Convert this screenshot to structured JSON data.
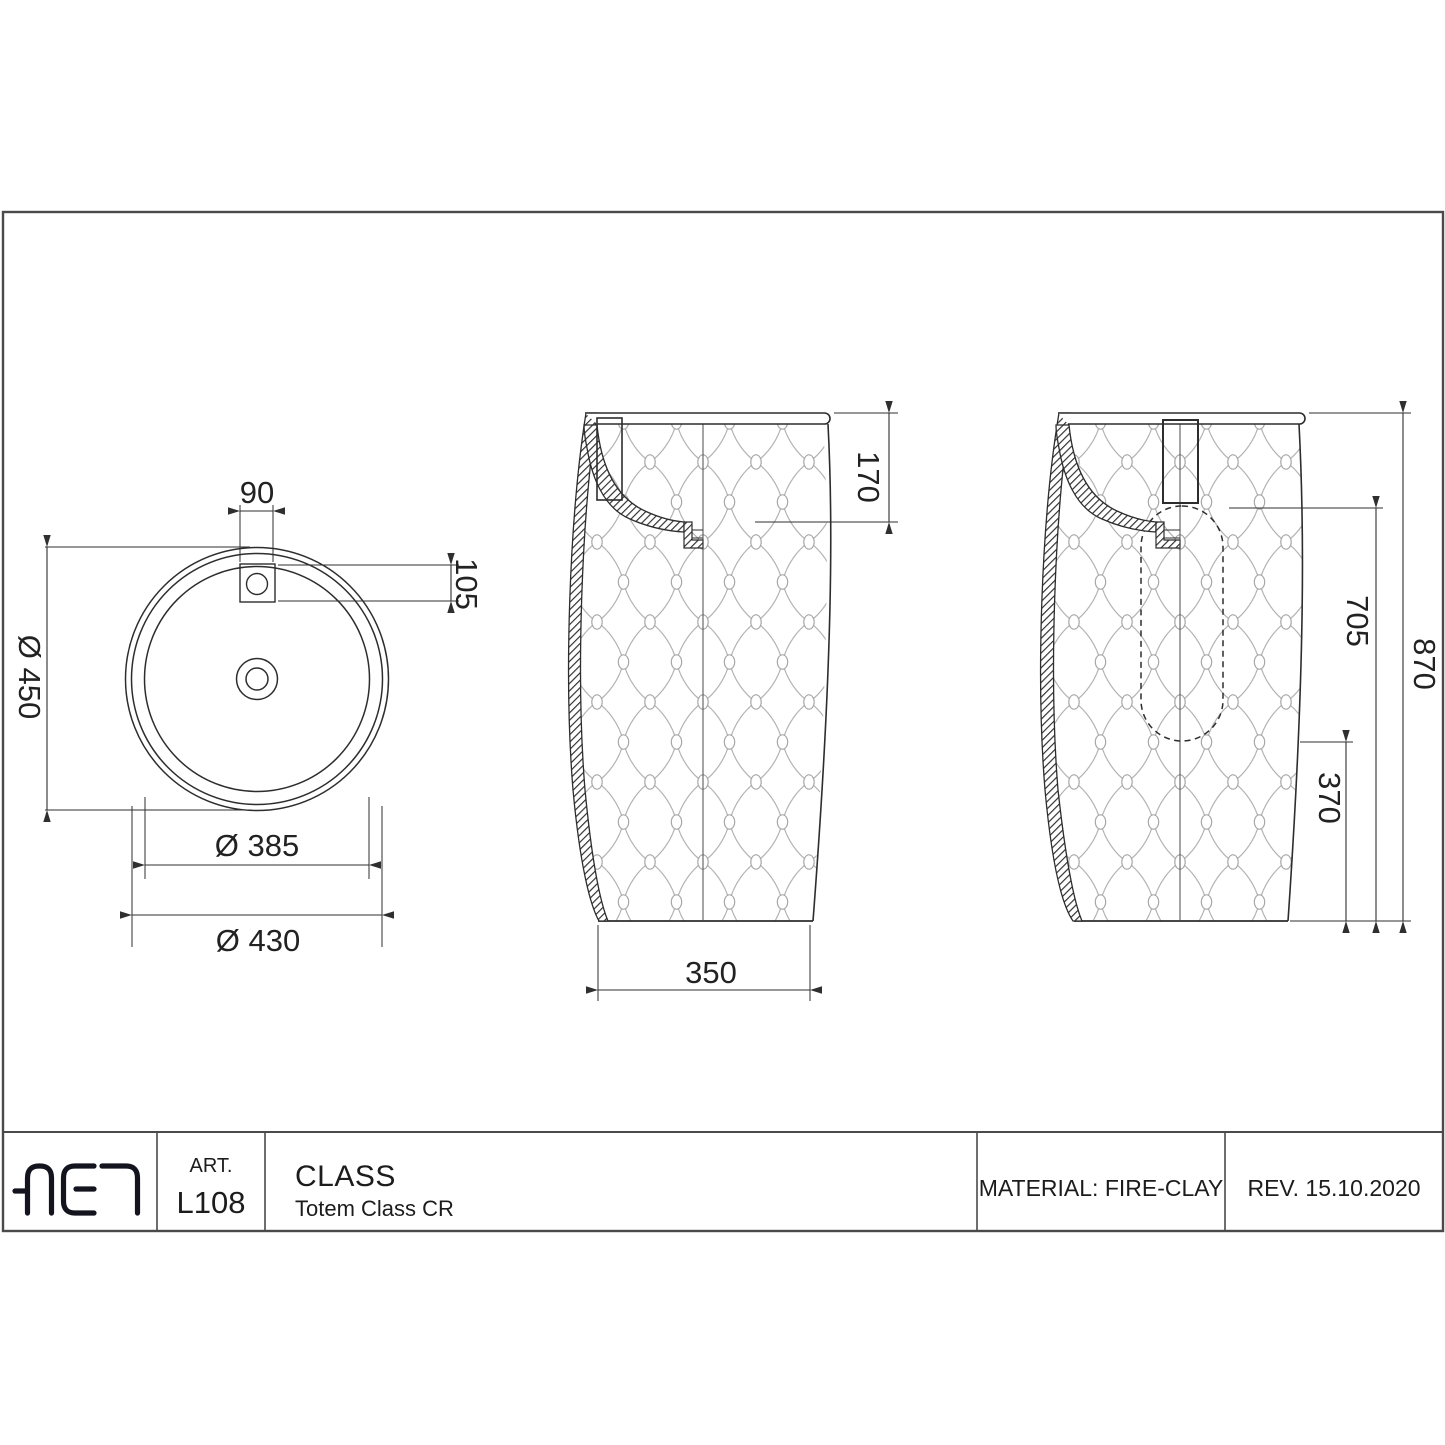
{
  "title_block": {
    "logo_text": "AET",
    "art_label": "ART.",
    "art_value": "L108",
    "product_title": "CLASS",
    "product_subtitle": "Totem Class CR",
    "material": "MATERIAL: FIRE-CLAY",
    "revision": "REV. 15.10.2020"
  },
  "views": {
    "top": {
      "dims": {
        "hole_width": "90",
        "hole_offset": "105",
        "outer_dia": "Ø 450",
        "inner_dia": "Ø 385",
        "body_dia": "Ø 430"
      }
    },
    "front": {
      "dims": {
        "basin_depth": "170",
        "base_width": "350"
      }
    },
    "side": {
      "dims": {
        "upper_height": "705",
        "total_height": "870",
        "lower_height": "370"
      }
    }
  }
}
